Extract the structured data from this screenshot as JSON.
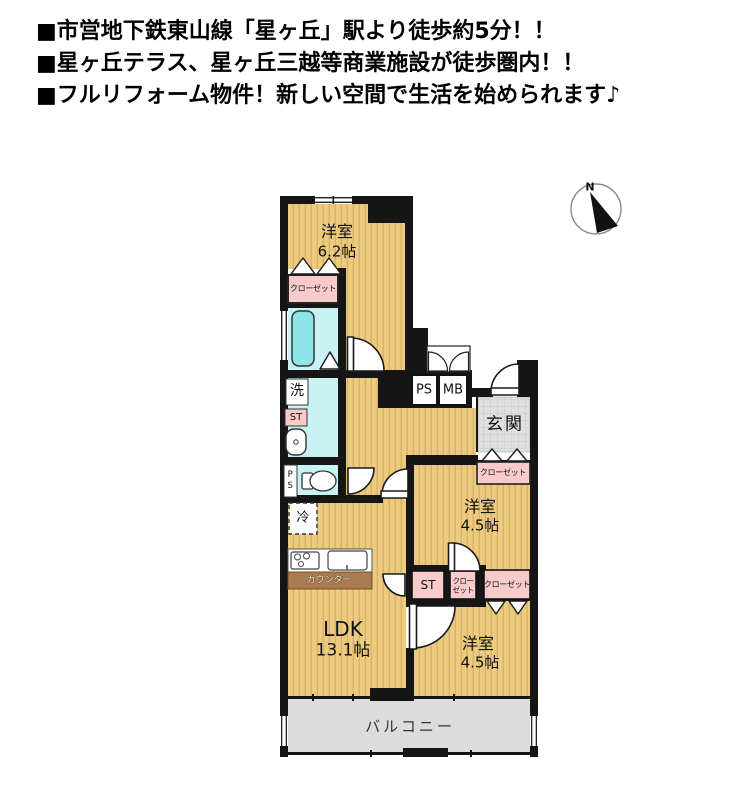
{
  "header": {
    "lines": [
      "■市営地下鉄東山線「星ヶ丘」駅より徒歩約5分！！",
      "■星ヶ丘テラス、星ヶ丘三越等商業施設が徒歩圏内！！",
      "■フルリフォーム物件！新しい空間で生活を始められます♪"
    ]
  },
  "compass": {
    "north_label": "N"
  },
  "plan": {
    "bedroom_top": {
      "label": "洋室",
      "area": "6.2帖"
    },
    "bedroom_mid": {
      "label": "洋室",
      "area": "4.5帖"
    },
    "bedroom_bottom": {
      "label": "洋室",
      "area": "4.5帖"
    },
    "ldk": {
      "label": "LDK",
      "area": "13.1帖"
    },
    "entrance_label": "玄関",
    "balcony_label": "バルコニー",
    "washroom_label": "洗",
    "refrigerator_label": "冷",
    "counter_label": "カウンター",
    "closet_top_label": "クローゼット",
    "closet_entrance_label": "クローゼット",
    "closet_mid_line1": "クロー",
    "closet_mid_line2": "ゼット",
    "closet_bottom_label": "クローゼット",
    "storage_wash_label": "ST",
    "storage_mid_label": "ST",
    "pipe_space_label": "PS",
    "meter_box_label": "MB",
    "pipe_space_wc_label": "PS"
  },
  "colors": {
    "floor_tan": "#edcb7e",
    "floor_stripe": "#d9b269",
    "closet_pink": "#f8caca",
    "wet_area_cyan": "#c9f2f4",
    "bathtub_cyan": "#8fe4e8",
    "entrance_tile_gray": "#e0e0e0",
    "balcony_gray": "#dcdcdc",
    "counter_brown": "#a87b50",
    "wall_black": "#151515"
  }
}
